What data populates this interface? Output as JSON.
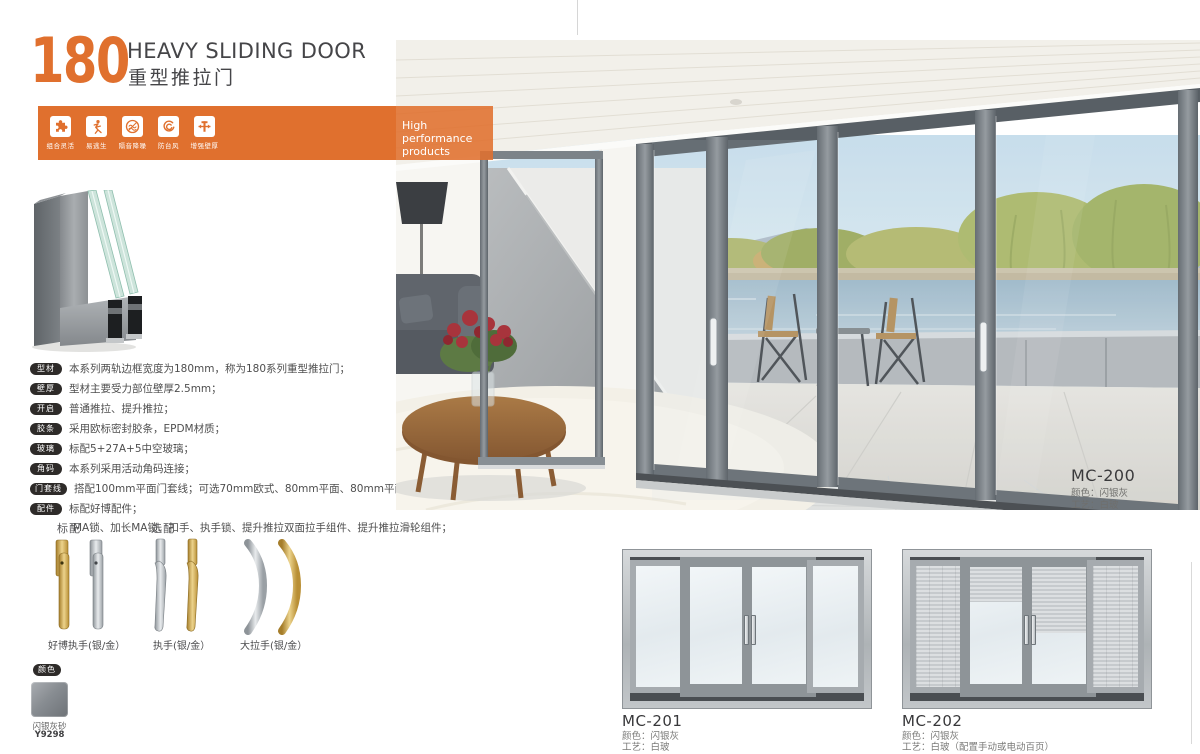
{
  "header": {
    "number": "180",
    "title_en": "HEAVY SLIDING DOOR",
    "title_cn": "重型推拉门",
    "accent_color": "#e0702e"
  },
  "banner": {
    "tagline": "High performance products",
    "features": [
      {
        "icon": "puzzle-icon",
        "label": "组合灵活"
      },
      {
        "icon": "running-man-icon",
        "label": "易逃生"
      },
      {
        "icon": "soundproof-icon",
        "label": "隔音降噪"
      },
      {
        "icon": "typhoon-icon",
        "label": "防台风"
      },
      {
        "icon": "wall-thickness-icon",
        "label": "增强壁厚"
      }
    ]
  },
  "specs": [
    {
      "tag": "型材",
      "text": "本系列两轨边框宽度为180mm，称为180系列重型推拉门；"
    },
    {
      "tag": "壁厚",
      "text": "型材主要受力部位壁厚2.5mm；"
    },
    {
      "tag": "开启",
      "text": "普通推拉、提升推拉；"
    },
    {
      "tag": "胶条",
      "text": "采用欧标密封胶条，EPDM材质；"
    },
    {
      "tag": "玻璃",
      "text": "标配5+27A+5中空玻璃；"
    },
    {
      "tag": "角码",
      "text": "本系列采用活动角码连接；"
    },
    {
      "tag": "门套线",
      "text": "搭配100mm平面门套线；可选70mm欧式、80mm平面、80mm平面；"
    },
    {
      "tag": "配件",
      "text": "标配好博配件；",
      "extra": "MA锁、加长MA锁、扣手、执手锁、提升推拉双面拉手组件、提升推拉滑轮组件；"
    }
  ],
  "handles": {
    "standard_label": "标配",
    "optional_label": "选配",
    "items": [
      {
        "caption": "好博执手(银/金）"
      },
      {
        "caption": "执手(银/金）"
      },
      {
        "caption": "大拉手(银/金）"
      }
    ]
  },
  "color_section": {
    "tag": "颜色",
    "name": "闪银灰砂",
    "code": "Y9298"
  },
  "hero": {
    "model": "MC-200",
    "color_line": "颜色：闪银灰",
    "craft_line": "工艺：白玻"
  },
  "products": [
    {
      "model": "MC-201",
      "color_line": "颜色：闪银灰",
      "craft_line": "工艺：白玻"
    },
    {
      "model": "MC-202",
      "color_line": "颜色：闪银灰",
      "craft_line": "工艺：白玻（配置手动或电动百页）"
    }
  ]
}
